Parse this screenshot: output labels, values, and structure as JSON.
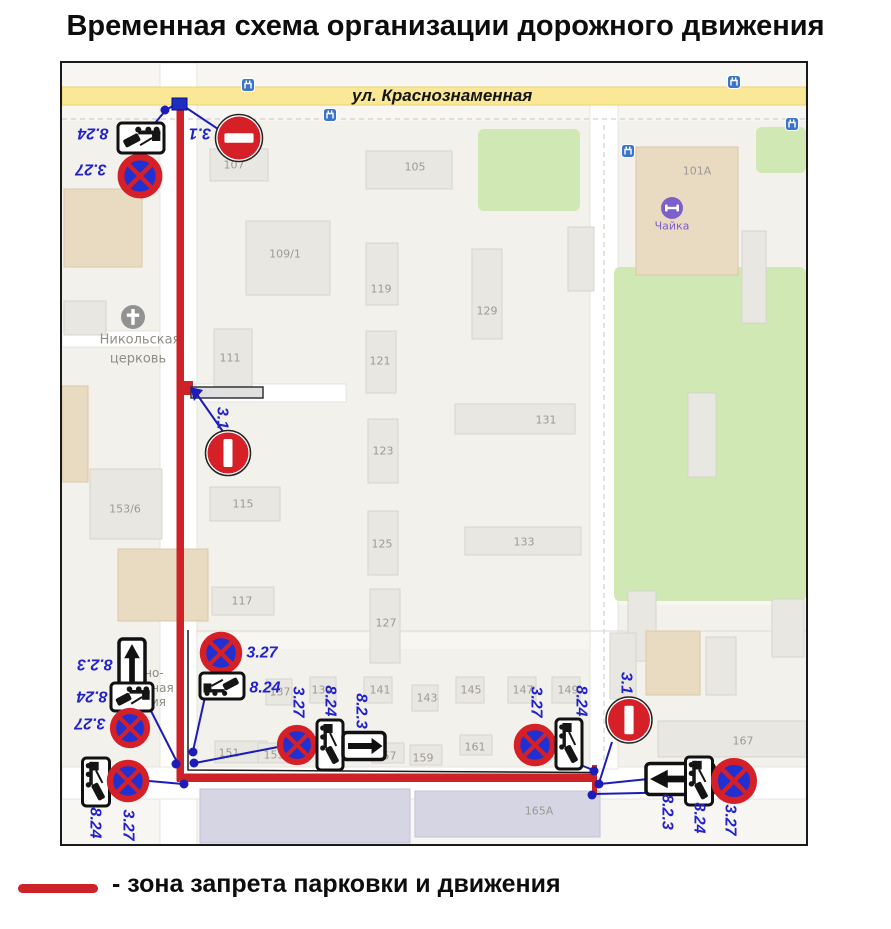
{
  "title": "Временная схема организации дорожного движения",
  "street": {
    "label": "ул.  Краснознаменная"
  },
  "legend": {
    "text": "- зона запрета парковки и движения",
    "line_color": "#cd2228"
  },
  "colors": {
    "zone_red": "#cd2228",
    "connector_blue": "#1c1cb8",
    "label_blue": "#2222cc",
    "sign_red": "#d62028",
    "sign_blue": "#2130d0",
    "road_yellow": "#fbe897",
    "green": "#cfe8b4",
    "building_gray": "#e9e7e1",
    "building_beige": "#e9dac2",
    "building_lilac": "#d6d5e3"
  },
  "map": {
    "blocks": [
      [
        62,
        120,
        98,
        646
      ],
      [
        196,
        120,
        394,
        512
      ],
      [
        196,
        648,
        396,
        118
      ],
      [
        618,
        120,
        188,
        146
      ],
      [
        618,
        604,
        188,
        162
      ]
    ],
    "roads": [
      {
        "x": 160,
        "y": 62,
        "w": 37,
        "h": 783
      },
      {
        "x": 62,
        "y": 766,
        "w": 744,
        "h": 32
      },
      {
        "x": 590,
        "y": 104,
        "w": 28,
        "h": 664
      },
      {
        "x": 196,
        "y": 383,
        "w": 150,
        "h": 18
      },
      {
        "x": 62,
        "y": 330,
        "w": 98,
        "h": 16
      },
      {
        "x": 62,
        "y": 86,
        "w": 744,
        "h": 18,
        "yellow": true
      }
    ],
    "dashes": [
      [
        62,
        118,
        806,
        118
      ],
      [
        604,
        124,
        604,
        764
      ]
    ],
    "thin_lines": [
      [
        196,
        630,
        806,
        630
      ]
    ],
    "greens": [
      [
        478,
        128,
        102,
        82
      ],
      [
        614,
        266,
        192,
        334
      ],
      [
        756,
        126,
        50,
        46
      ]
    ],
    "buildings": [
      [
        64,
        188,
        78,
        78,
        "b"
      ],
      [
        64,
        300,
        42,
        34,
        "g"
      ],
      [
        62,
        385,
        26,
        96,
        "b"
      ],
      [
        90,
        468,
        72,
        70,
        "g"
      ],
      [
        118,
        548,
        90,
        72,
        "b"
      ],
      [
        210,
        148,
        58,
        32,
        "g"
      ],
      [
        366,
        150,
        86,
        38,
        "g"
      ],
      [
        246,
        220,
        84,
        74,
        "g"
      ],
      [
        366,
        242,
        32,
        62,
        "g"
      ],
      [
        472,
        248,
        30,
        90,
        "g"
      ],
      [
        214,
        328,
        38,
        62,
        "g"
      ],
      [
        366,
        330,
        30,
        62,
        "g"
      ],
      [
        455,
        403,
        120,
        30,
        "g"
      ],
      [
        368,
        418,
        30,
        64,
        "g"
      ],
      [
        210,
        486,
        70,
        34,
        "g"
      ],
      [
        368,
        510,
        30,
        64,
        "g"
      ],
      [
        465,
        526,
        116,
        28,
        "g"
      ],
      [
        212,
        586,
        62,
        28,
        "g"
      ],
      [
        370,
        588,
        30,
        74,
        "g"
      ],
      [
        568,
        226,
        26,
        64,
        "g"
      ],
      [
        266,
        678,
        26,
        26,
        "g"
      ],
      [
        310,
        676,
        26,
        26,
        "g"
      ],
      [
        364,
        676,
        28,
        26,
        "g"
      ],
      [
        412,
        684,
        26,
        26,
        "g"
      ],
      [
        456,
        676,
        28,
        26,
        "g"
      ],
      [
        508,
        676,
        28,
        26,
        "g"
      ],
      [
        552,
        676,
        28,
        26,
        "g"
      ],
      [
        215,
        740,
        52,
        22,
        "g"
      ],
      [
        258,
        742,
        42,
        20,
        "g"
      ],
      [
        372,
        742,
        32,
        20,
        "g"
      ],
      [
        410,
        744,
        32,
        20,
        "g"
      ],
      [
        460,
        734,
        32,
        20,
        "g"
      ],
      [
        200,
        788,
        210,
        54,
        "l"
      ],
      [
        415,
        790,
        185,
        46,
        "l"
      ],
      [
        658,
        720,
        148,
        36,
        "g"
      ],
      [
        636,
        146,
        102,
        128,
        "b"
      ],
      [
        742,
        230,
        24,
        92,
        "g"
      ],
      [
        688,
        392,
        28,
        84,
        "g"
      ],
      [
        628,
        590,
        28,
        70,
        "g"
      ],
      [
        772,
        598,
        32,
        58,
        "g"
      ],
      [
        610,
        632,
        26,
        66,
        "g"
      ],
      [
        646,
        630,
        54,
        64,
        "b"
      ],
      [
        706,
        636,
        30,
        58,
        "g"
      ]
    ],
    "labels": [
      {
        "t": "107",
        "x": 234,
        "y": 164
      },
      {
        "t": "105",
        "x": 415,
        "y": 166
      },
      {
        "t": "101А",
        "x": 697,
        "y": 170
      },
      {
        "t": "109/1",
        "x": 285,
        "y": 253
      },
      {
        "t": "119",
        "x": 381,
        "y": 288
      },
      {
        "t": "129",
        "x": 487,
        "y": 310
      },
      {
        "t": "111",
        "x": 230,
        "y": 357
      },
      {
        "t": "121",
        "x": 380,
        "y": 360
      },
      {
        "t": "131",
        "x": 546,
        "y": 419
      },
      {
        "t": "123",
        "x": 383,
        "y": 450
      },
      {
        "t": "115",
        "x": 243,
        "y": 503
      },
      {
        "t": "125",
        "x": 382,
        "y": 543
      },
      {
        "t": "133",
        "x": 524,
        "y": 541
      },
      {
        "t": "153/6",
        "x": 125,
        "y": 508
      },
      {
        "t": "117",
        "x": 242,
        "y": 600
      },
      {
        "t": "127",
        "x": 386,
        "y": 622
      },
      {
        "t": "137",
        "x": 280,
        "y": 691
      },
      {
        "t": "139",
        "x": 322,
        "y": 689
      },
      {
        "t": "141",
        "x": 380,
        "y": 689
      },
      {
        "t": "143",
        "x": 427,
        "y": 697
      },
      {
        "t": "145",
        "x": 471,
        "y": 689
      },
      {
        "t": "147",
        "x": 523,
        "y": 689
      },
      {
        "t": "149",
        "x": 568,
        "y": 689
      },
      {
        "t": "151",
        "x": 229,
        "y": 752
      },
      {
        "t": "153",
        "x": 274,
        "y": 754
      },
      {
        "t": "157",
        "x": 386,
        "y": 755
      },
      {
        "t": "159",
        "x": 423,
        "y": 757
      },
      {
        "t": "161",
        "x": 475,
        "y": 746
      },
      {
        "t": "165А",
        "x": 539,
        "y": 810
      },
      {
        "t": "167",
        "x": 743,
        "y": 740
      },
      {
        "t": "Никольская",
        "x": 140,
        "y": 339,
        "s": 13,
        "c": "#8f8d85"
      },
      {
        "t": "церковь",
        "x": 138,
        "y": 358,
        "s": 13,
        "c": "#8f8d85"
      },
      {
        "t": "нно-",
        "x": 150,
        "y": 672,
        "s": 12,
        "c": "#8f8d85"
      },
      {
        "t": "шная",
        "x": 157,
        "y": 687,
        "s": 12,
        "c": "#8f8d85"
      },
      {
        "t": "мия",
        "x": 154,
        "y": 701,
        "s": 12,
        "c": "#8f8d85"
      },
      {
        "t": "Чайка",
        "x": 672,
        "y": 225,
        "s": 11,
        "c": "#7d5fc9"
      }
    ],
    "bus_icons": [
      [
        248,
        84
      ],
      [
        734,
        81
      ],
      [
        330,
        114
      ],
      [
        792,
        123
      ],
      [
        628,
        150
      ]
    ],
    "church_icon": {
      "x": 133,
      "y": 316,
      "r": 12
    },
    "gym_icon": {
      "x": 672,
      "y": 207,
      "r": 11
    },
    "zone": {
      "vertical": {
        "x": 176.5,
        "y": 104,
        "w": 7.5,
        "h": 676
      },
      "horizontal": {
        "x": 177,
        "y": 772.5,
        "w": 419,
        "h": 8.5
      },
      "end_tick": {
        "x": 592,
        "y": 764,
        "w": 5,
        "h": 28
      },
      "black_inner": [
        [
          188,
          629
        ],
        [
          188,
          769
        ],
        [
          594,
          771.5
        ]
      ],
      "junction_tick": {
        "x": 184,
        "y": 380,
        "w": 9,
        "h": 14
      }
    },
    "barrier": {
      "x": 191,
      "y": 386,
      "w": 72,
      "h": 11
    },
    "marker_square": {
      "x": 172,
      "y": 97,
      "w": 15,
      "h": 12
    },
    "dots": [
      [
        165,
        109
      ],
      [
        193,
        751
      ],
      [
        194,
        762
      ],
      [
        176,
        763
      ],
      [
        184,
        783
      ],
      [
        594,
        770
      ],
      [
        599,
        783
      ],
      [
        592,
        794
      ]
    ],
    "connectors": [
      [
        176,
        103,
        166,
        109
      ],
      [
        166,
        109,
        150,
        128
      ],
      [
        182,
        104,
        218,
        128
      ],
      [
        196,
        392,
        224,
        432
      ],
      [
        205,
        696,
        193,
        750
      ],
      [
        278,
        746,
        195,
        762
      ],
      [
        150,
        708,
        177,
        761
      ],
      [
        149,
        780,
        183,
        783
      ],
      [
        578,
        763,
        593,
        769
      ],
      [
        612,
        741,
        599,
        782
      ],
      [
        648,
        778,
        600,
        783
      ],
      [
        686,
        791,
        593,
        793
      ]
    ],
    "arrowhead": [
      [
        190,
        386
      ],
      [
        203,
        389
      ],
      [
        194,
        400
      ]
    ],
    "signs": [
      {
        "k": "ns",
        "x": 140,
        "y": 175,
        "d": 44
      },
      {
        "k": "ne",
        "x": 239,
        "y": 137,
        "d": 47,
        "bar": "h"
      },
      {
        "k": "tow",
        "x": 141,
        "y": 137,
        "w": 46,
        "h": 30,
        "r": 180
      },
      {
        "k": "ne",
        "x": 228,
        "y": 452,
        "d": 45,
        "bar": "v"
      },
      {
        "k": "ar",
        "x": 132,
        "y": 670,
        "w": 26,
        "h": 64,
        "dir": "up"
      },
      {
        "k": "tow",
        "x": 132,
        "y": 696,
        "w": 42,
        "h": 28,
        "r": 180
      },
      {
        "k": "ns",
        "x": 130,
        "y": 727,
        "d": 40
      },
      {
        "k": "ns",
        "x": 221,
        "y": 652,
        "d": 42
      },
      {
        "k": "tow",
        "x": 222,
        "y": 685,
        "w": 44,
        "h": 26,
        "r": 0
      },
      {
        "k": "tow",
        "x": 96,
        "y": 781,
        "w": 48,
        "h": 27,
        "r": 90
      },
      {
        "k": "ns",
        "x": 128,
        "y": 780,
        "d": 42
      },
      {
        "k": "ns",
        "x": 297,
        "y": 744,
        "d": 40
      },
      {
        "k": "tow",
        "x": 330,
        "y": 744,
        "w": 50,
        "h": 26,
        "r": 90
      },
      {
        "k": "ar",
        "x": 364,
        "y": 745,
        "w": 42,
        "h": 27,
        "dir": "right"
      },
      {
        "k": "ns",
        "x": 535,
        "y": 744,
        "d": 42
      },
      {
        "k": "tow",
        "x": 569,
        "y": 743,
        "w": 50,
        "h": 26,
        "r": 90
      },
      {
        "k": "ne",
        "x": 629,
        "y": 719,
        "d": 46,
        "bar": "v"
      },
      {
        "k": "ar",
        "x": 680,
        "y": 778,
        "w": 68,
        "h": 31,
        "dir": "left"
      },
      {
        "k": "tow",
        "x": 699,
        "y": 780,
        "w": 48,
        "h": 27,
        "r": 90
      },
      {
        "k": "ns",
        "x": 734,
        "y": 780,
        "d": 45
      }
    ],
    "sign_labels": [
      {
        "t": "8.24",
        "x": 93,
        "y": 132,
        "r": 180
      },
      {
        "t": "3.27",
        "x": 91,
        "y": 168,
        "r": 180
      },
      {
        "t": "3.1",
        "x": 200,
        "y": 132,
        "r": 180
      },
      {
        "t": "3.1",
        "x": 222,
        "y": 417,
        "r": 90
      },
      {
        "t": "8.2.3",
        "x": 95,
        "y": 663,
        "r": 180
      },
      {
        "t": "8.24",
        "x": 92,
        "y": 695,
        "r": 180
      },
      {
        "t": "3.27",
        "x": 90,
        "y": 722,
        "r": 180
      },
      {
        "t": "3.27",
        "x": 262,
        "y": 652,
        "r": 0
      },
      {
        "t": "8.24",
        "x": 265,
        "y": 687,
        "r": 0
      },
      {
        "t": "8.24",
        "x": 95,
        "y": 822,
        "r": 90
      },
      {
        "t": "3.27",
        "x": 128,
        "y": 824,
        "r": 90
      },
      {
        "t": "3.27",
        "x": 298,
        "y": 701,
        "r": 90
      },
      {
        "t": "8.24",
        "x": 330,
        "y": 700,
        "r": 90
      },
      {
        "t": "8.2.3",
        "x": 361,
        "y": 710,
        "r": 90
      },
      {
        "t": "3.27",
        "x": 536,
        "y": 701,
        "r": 90
      },
      {
        "t": "8.24",
        "x": 581,
        "y": 700,
        "r": 90
      },
      {
        "t": "3.1",
        "x": 626,
        "y": 682,
        "r": 90
      },
      {
        "t": "8.2.3",
        "x": 667,
        "y": 811,
        "r": 90
      },
      {
        "t": "8.24",
        "x": 699,
        "y": 817,
        "r": 90
      },
      {
        "t": "3.27",
        "x": 730,
        "y": 819,
        "r": 90
      }
    ]
  }
}
